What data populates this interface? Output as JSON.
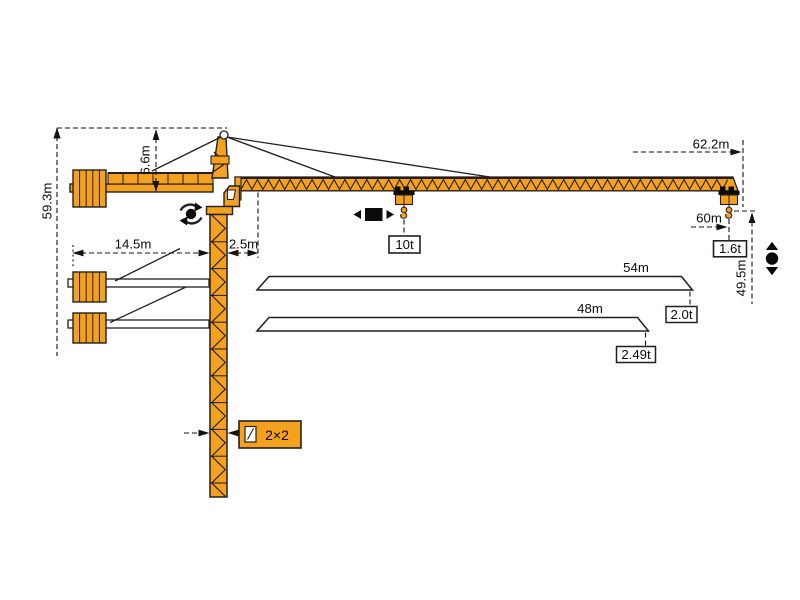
{
  "labels": {
    "total_height": "59.3m",
    "head_height": "6.6m",
    "counterjib_radius": "14.5m",
    "rear_offset": "2.5m",
    "jib_length_overall": "62.2m",
    "max_radius": "60m",
    "hook_height": "49.5m",
    "load_mid_jib": "10t",
    "load_tip_60m": "1.6t",
    "mast_section": "2×2"
  },
  "jib_variants": [
    {
      "length": "54m",
      "tip_load": "2.0t"
    },
    {
      "length": "48m",
      "tip_load": "2.49t"
    }
  ],
  "icons": {
    "slewing": "slewing-icon",
    "trolley_travel": "trolley-travel-icon",
    "hoist": "hoist-icon",
    "mast_section": "mast-section-icon"
  },
  "colors": {
    "crane_yellow": "#F5A120",
    "outline_black": "#241F1C",
    "background": "#FFFFFF"
  }
}
